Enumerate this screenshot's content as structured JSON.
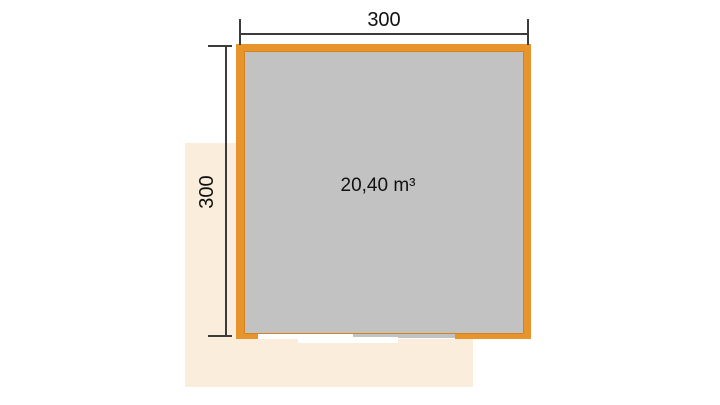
{
  "labels": {
    "width": "300",
    "depth": "300",
    "volume": "20,40 m³"
  },
  "colors": {
    "background": "#FFFFFF",
    "wall": "#E8942D",
    "wall_inner_edge": "#D2821E",
    "floor": "#C2C2C2",
    "terrace": "#FAEDDB",
    "opening": "#FFFFFF",
    "dimension_line": "#3C3C3C",
    "text": "#111111"
  }
}
